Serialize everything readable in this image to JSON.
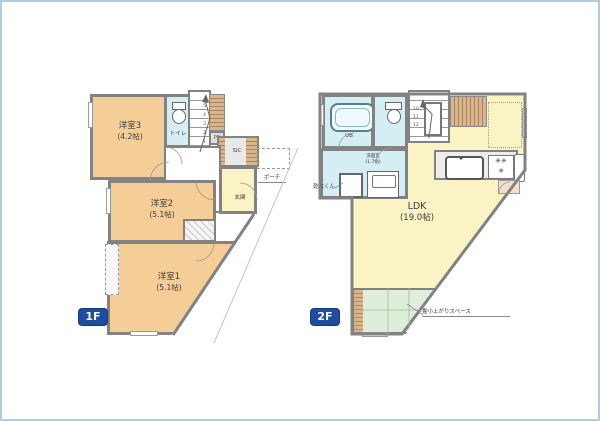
{
  "colors": {
    "room_orange": "#f5cd97",
    "room_yellow": "#faf3c4",
    "wet_area_blue": "#d5eef4",
    "tatami_green": "#dfeeda",
    "wood_hatch": "#cfa878",
    "wall_gray": "#828282",
    "badge_blue": "#1e4da0",
    "frame_blue": "#aecbe8"
  },
  "floor1": {
    "badge": "1F",
    "rooms": {
      "y3": {
        "name": "洋室3",
        "size": "(4.2帖)"
      },
      "y2": {
        "name": "洋室2",
        "size": "(5.1帖)"
      },
      "y1": {
        "name": "洋室1",
        "size": "(5.1帖)"
      },
      "toilet": {
        "name": "トイレ"
      },
      "hall": {
        "name": "ホール"
      },
      "genkan": {
        "name": "玄関"
      },
      "porch": {
        "name": "ポーチ"
      },
      "ps": {
        "name": "PS"
      },
      "sic": {
        "name": "SIC"
      }
    },
    "stairs": {
      "numbers": "5\n4\n3\n2\n1"
    }
  },
  "floor2": {
    "badge": "2F",
    "rooms": {
      "ldk": {
        "name": "LDK",
        "size": "(19.0帖)"
      },
      "ub": {
        "name": "UB"
      },
      "senmen": {
        "name": "洗面室",
        "size": "(1.7帖)"
      },
      "tatami": {
        "name": "畳小上がりスペース"
      }
    },
    "labels": {
      "dryer": "乾太くん"
    },
    "stairs": {
      "numbers": "10\n11\n12"
    },
    "kitchen": {
      "stove_icon": "✳✳\n✳"
    }
  }
}
